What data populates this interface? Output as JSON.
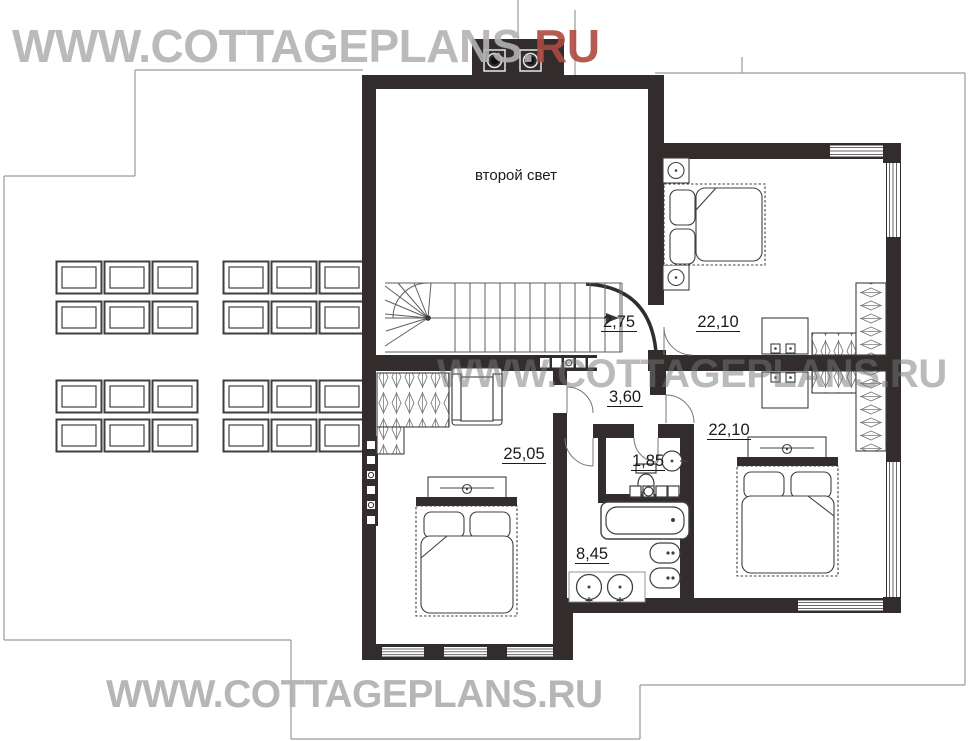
{
  "watermarks": {
    "top_prefix": "WWW.COTTAGEPLANS.",
    "top_suffix": "RU",
    "middle": "WWW.COTTAGEPLANS.RU",
    "bottom": "WWW.COTTAGEPLANS.RU"
  },
  "plan": {
    "floor_name_label": "второй свет"
  },
  "rooms": {
    "landing": {
      "area": "2,75"
    },
    "bedroom_top_right": {
      "area": "22,10"
    },
    "hall": {
      "area": "3,60"
    },
    "bedroom_master": {
      "area": "25,05"
    },
    "wc": {
      "area": "1,85"
    },
    "bathroom": {
      "area": "8,45"
    },
    "bedroom_bottom_right": {
      "area": "22,10"
    }
  },
  "colors": {
    "wall": "#322d2c",
    "roof_line": "#9a9a9a",
    "window_line": "#6a6a6a",
    "furniture_line": "#3f3f3f",
    "watermark_gray": "#b3b3b3",
    "watermark_gray_mid": "#787878",
    "watermark_red": "#ad4a3f",
    "label_text": "#1b1b1b"
  }
}
